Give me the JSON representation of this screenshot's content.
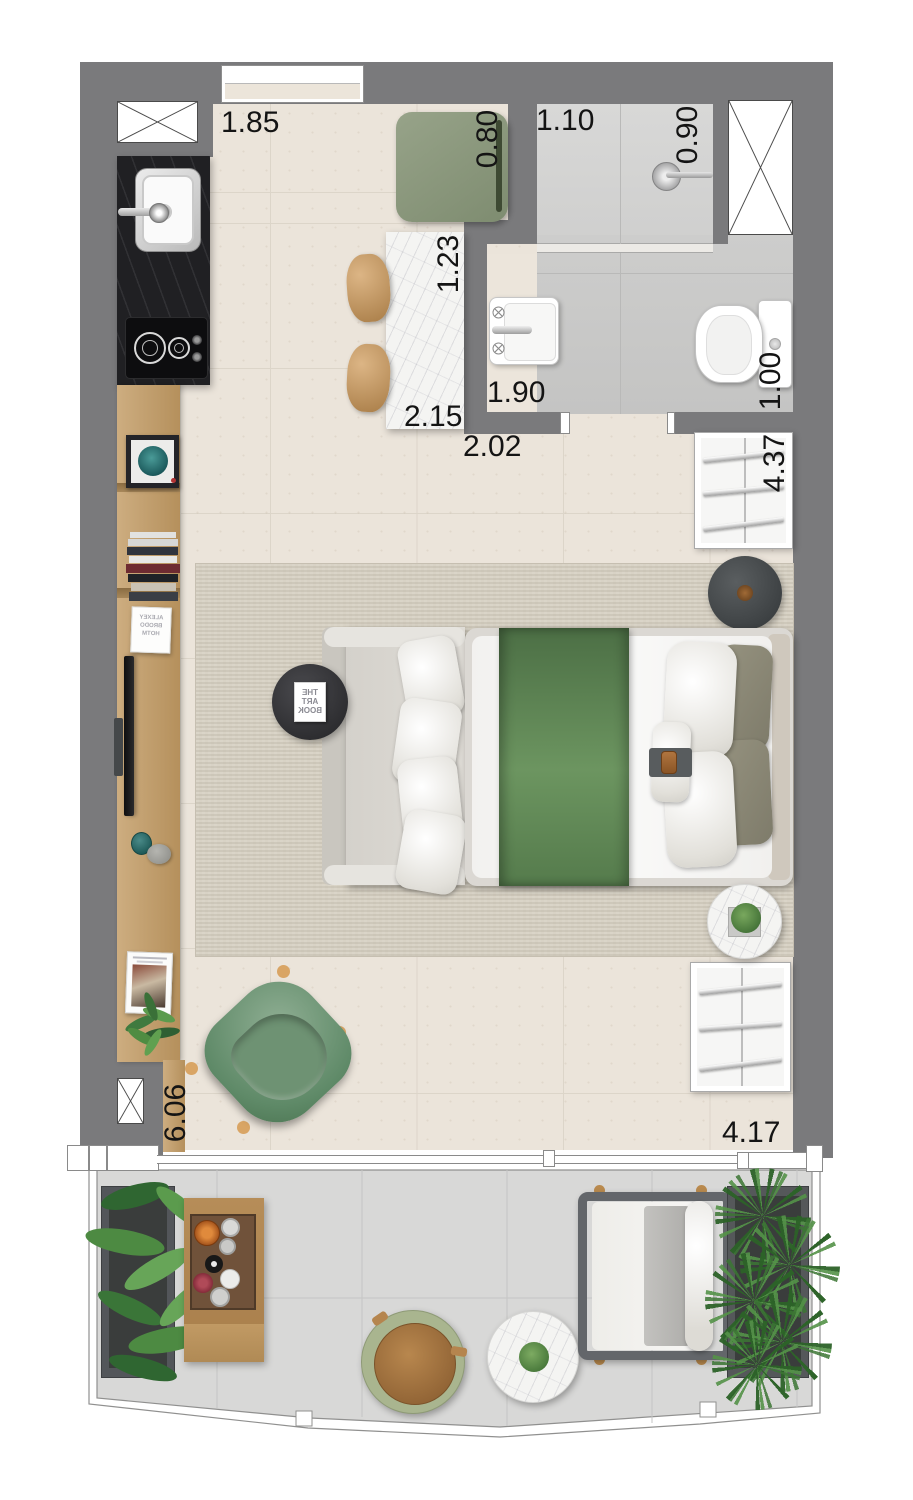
{
  "plan": {
    "type": "apartment-floor-plan",
    "unit_hint": "meters"
  },
  "labels": [
    {
      "id": "kitchen-width",
      "text": "1.85",
      "orientation": "horizontal"
    },
    {
      "id": "cabinet-width",
      "text": "0.80",
      "orientation": "vertical"
    },
    {
      "id": "shower-width",
      "text": "1.10",
      "orientation": "horizontal"
    },
    {
      "id": "shower-depth",
      "text": "0.90",
      "orientation": "vertical"
    },
    {
      "id": "table-width",
      "text": "1.23",
      "orertation": "vertical",
      "orientation": "vertical"
    },
    {
      "id": "dining-length",
      "text": "2.15",
      "orientation": "horizontal"
    },
    {
      "id": "hall-width",
      "text": "2.02",
      "orientation": "horizontal"
    },
    {
      "id": "bath-width",
      "text": "1.90",
      "orientation": "horizontal"
    },
    {
      "id": "toilet-width",
      "text": "1.00",
      "orientation": "vertical"
    },
    {
      "id": "bedroom-length",
      "text": "4.37",
      "orientation": "vertical"
    },
    {
      "id": "living-length",
      "text": "6.06",
      "orientation": "vertical"
    },
    {
      "id": "balcony-width",
      "text": "4.17",
      "orientation": "horizontal"
    }
  ],
  "texts": {
    "coffee_table_book": [
      "THE",
      "ART",
      "BOOK"
    ],
    "sideboard_magazine": [
      "ALEXEY",
      "BRODO",
      "HOTM"
    ]
  },
  "colors": {
    "wall": "#7a7a7c",
    "floor": "#ebe4da",
    "bathroom_floor": "#c8c8c7",
    "rug": "#d8d2c5",
    "balcony_floor": "#d8d8d7",
    "kitchen_counter": "#202023",
    "wood": "#c2a173",
    "green_cabinet": "#8a977c",
    "green_armchair": "#6f9478",
    "bed_runner_green": "#5a814f",
    "marble": "#f4f4f2"
  }
}
